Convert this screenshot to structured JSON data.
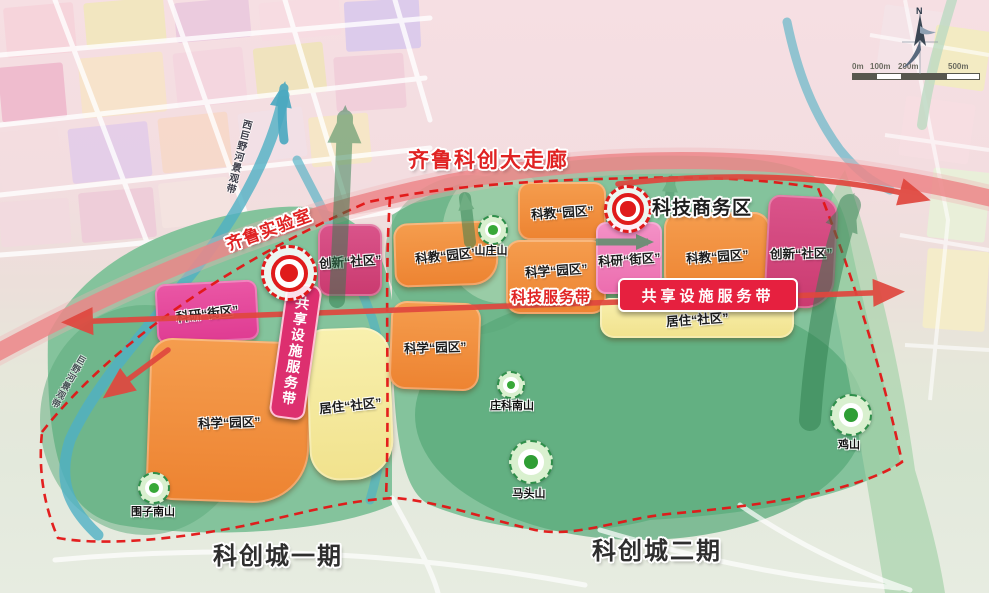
{
  "title": {
    "corridor": "齐鲁科创大走廊"
  },
  "landmarks": {
    "qilu_lab": "齐鲁实验室",
    "tech_business": "科技商务区"
  },
  "axes": {
    "service_band": "科技服务带",
    "shared_band_vertical": "共享设施服务带",
    "shared_band_horizontal": "共享设施服务带"
  },
  "zones": [
    {
      "id": "keyan-jiequ-west",
      "label": "科研“街区”"
    },
    {
      "id": "kexue-yuanqu-west",
      "label": "科学“园区”"
    },
    {
      "id": "juzhu-shequ-west",
      "label": "居住“社区”"
    },
    {
      "id": "chuangxin-shequ-west",
      "label": "创新“社区”"
    },
    {
      "id": "kejiao-yuanqu-mid",
      "label": "科教“园区”"
    },
    {
      "id": "kexue-yuanqu-mid",
      "label": "科学“园区”"
    },
    {
      "id": "kejiao-yuanqu-top",
      "label": "科教“园区”"
    },
    {
      "id": "kexue-yuanqu-center",
      "label": "科学“园区”"
    },
    {
      "id": "keyan-jiequ-east",
      "label": "科研“街区”"
    },
    {
      "id": "kejiao-yuanqu-east",
      "label": "科教“园区”"
    },
    {
      "id": "chuangxin-shequ-east",
      "label": "创新“社区”"
    },
    {
      "id": "juzhu-shequ-east",
      "label": "居住“社区”"
    }
  ],
  "mountains": [
    {
      "id": "shanzhuangshan",
      "label": "山庄山"
    },
    {
      "id": "zhuangkenanshan",
      "label": "庄科南山"
    },
    {
      "id": "matoushan",
      "label": "马头山"
    },
    {
      "id": "jishan",
      "label": "鸡山"
    },
    {
      "id": "weizinanshan",
      "label": "围子南山"
    }
  ],
  "phases": {
    "one": "科创城一期",
    "two": "科创城二期"
  },
  "rivers": {
    "west": "西巨野河景观带",
    "south": "巨野河景观带"
  },
  "compass": {
    "north": "N"
  },
  "scalebar": {
    "ticks": [
      "0m",
      "100m",
      "200m",
      "500m"
    ]
  },
  "colors": {
    "boundary": "#e31515",
    "corridor": "#ec8386",
    "banner_red": "#e6203f",
    "banner_pink": "#dd2f6f"
  }
}
